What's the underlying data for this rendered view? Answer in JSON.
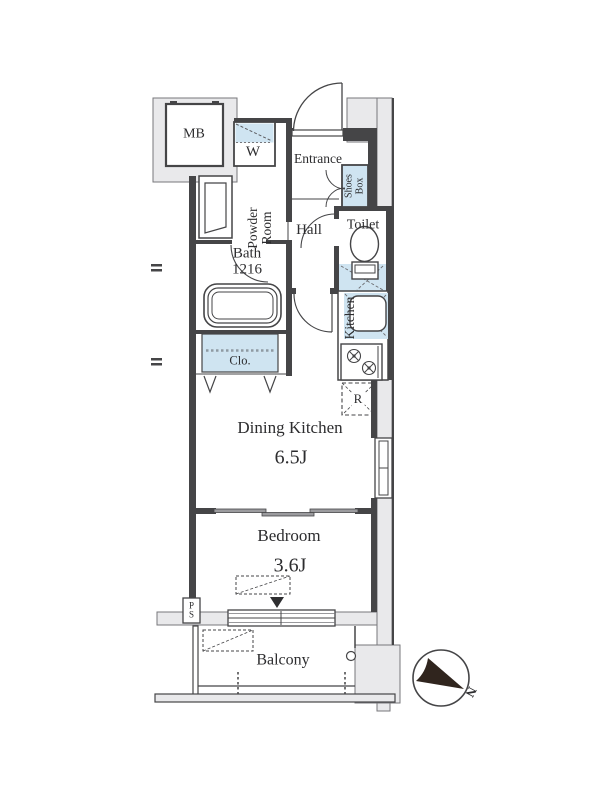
{
  "plan": {
    "mb": "MB",
    "washer": "W",
    "powder_room": "Powder Room",
    "entrance": "Entrance",
    "shoes_box": "Shoes Box",
    "hall": "Hall",
    "toilet": "Toilet",
    "bath": "Bath 1216",
    "closet": "Clo.",
    "kitchen": "Kitchen",
    "refrigerator": "R",
    "dining_kitchen": "Dining Kitchen",
    "dining_kitchen_size": "6.5J",
    "bedroom": "Bedroom",
    "bedroom_size": "3.6J",
    "pipe_space": "PS",
    "balcony": "Balcony",
    "compass_north": "N"
  },
  "colors": {
    "wall": "#454547",
    "exterior_fill": "#e9e9eb",
    "water_blue": "#cfe4f1"
  }
}
